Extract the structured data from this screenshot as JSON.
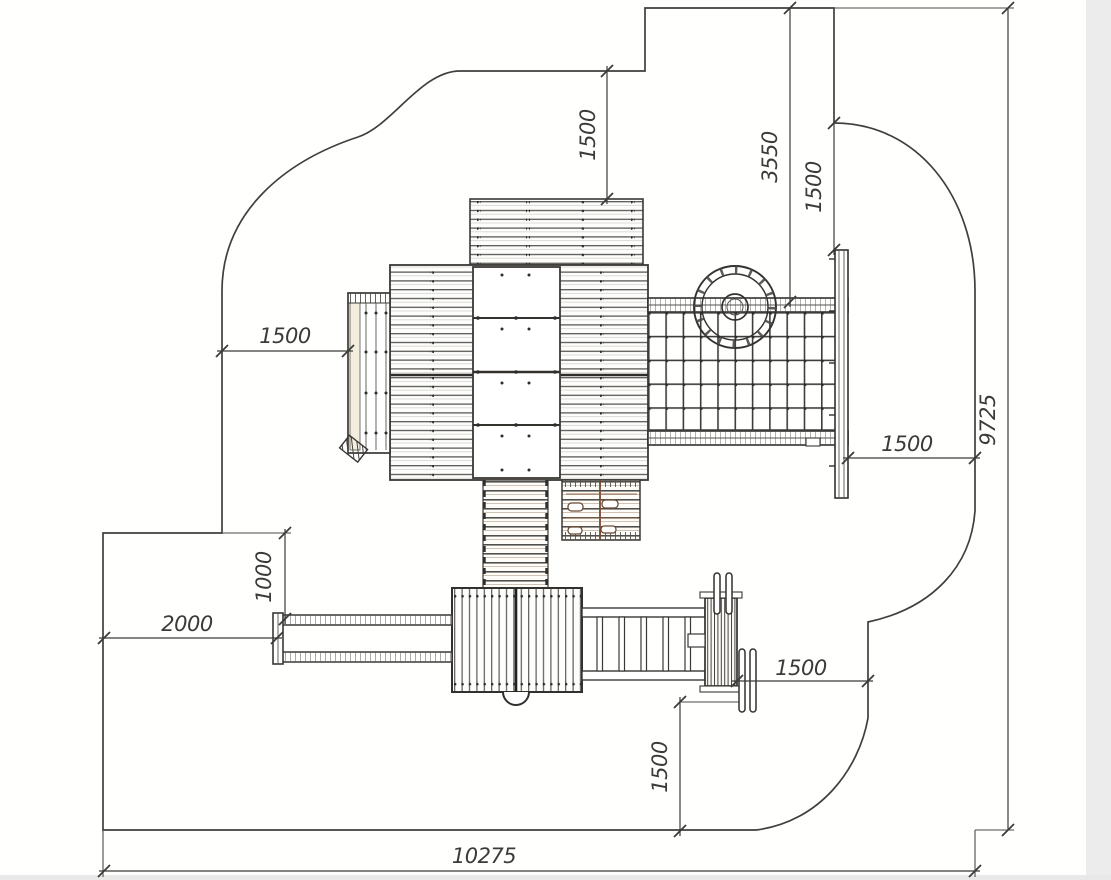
{
  "drawing": {
    "type": "playground-equipment-plan-view",
    "colors": {
      "line": "#3f3f3c",
      "structure": "#4a4a47",
      "wood_accent": "#8a5a3a",
      "ramp_tint": "#f3eedd",
      "background": "#ffffff",
      "scan_edge": "#ececec"
    },
    "dimensions": {
      "top_1500": "1500",
      "span_3550": "3550",
      "top_right_1500": "1500",
      "left_1500": "1500",
      "zone_1000": "1000",
      "zone_2000": "2000",
      "right_1500": "1500",
      "bottom_h_1500": "1500",
      "bottom_v_1500": "1500",
      "total_height_9725": "9725",
      "total_width_10275": "10275"
    }
  }
}
